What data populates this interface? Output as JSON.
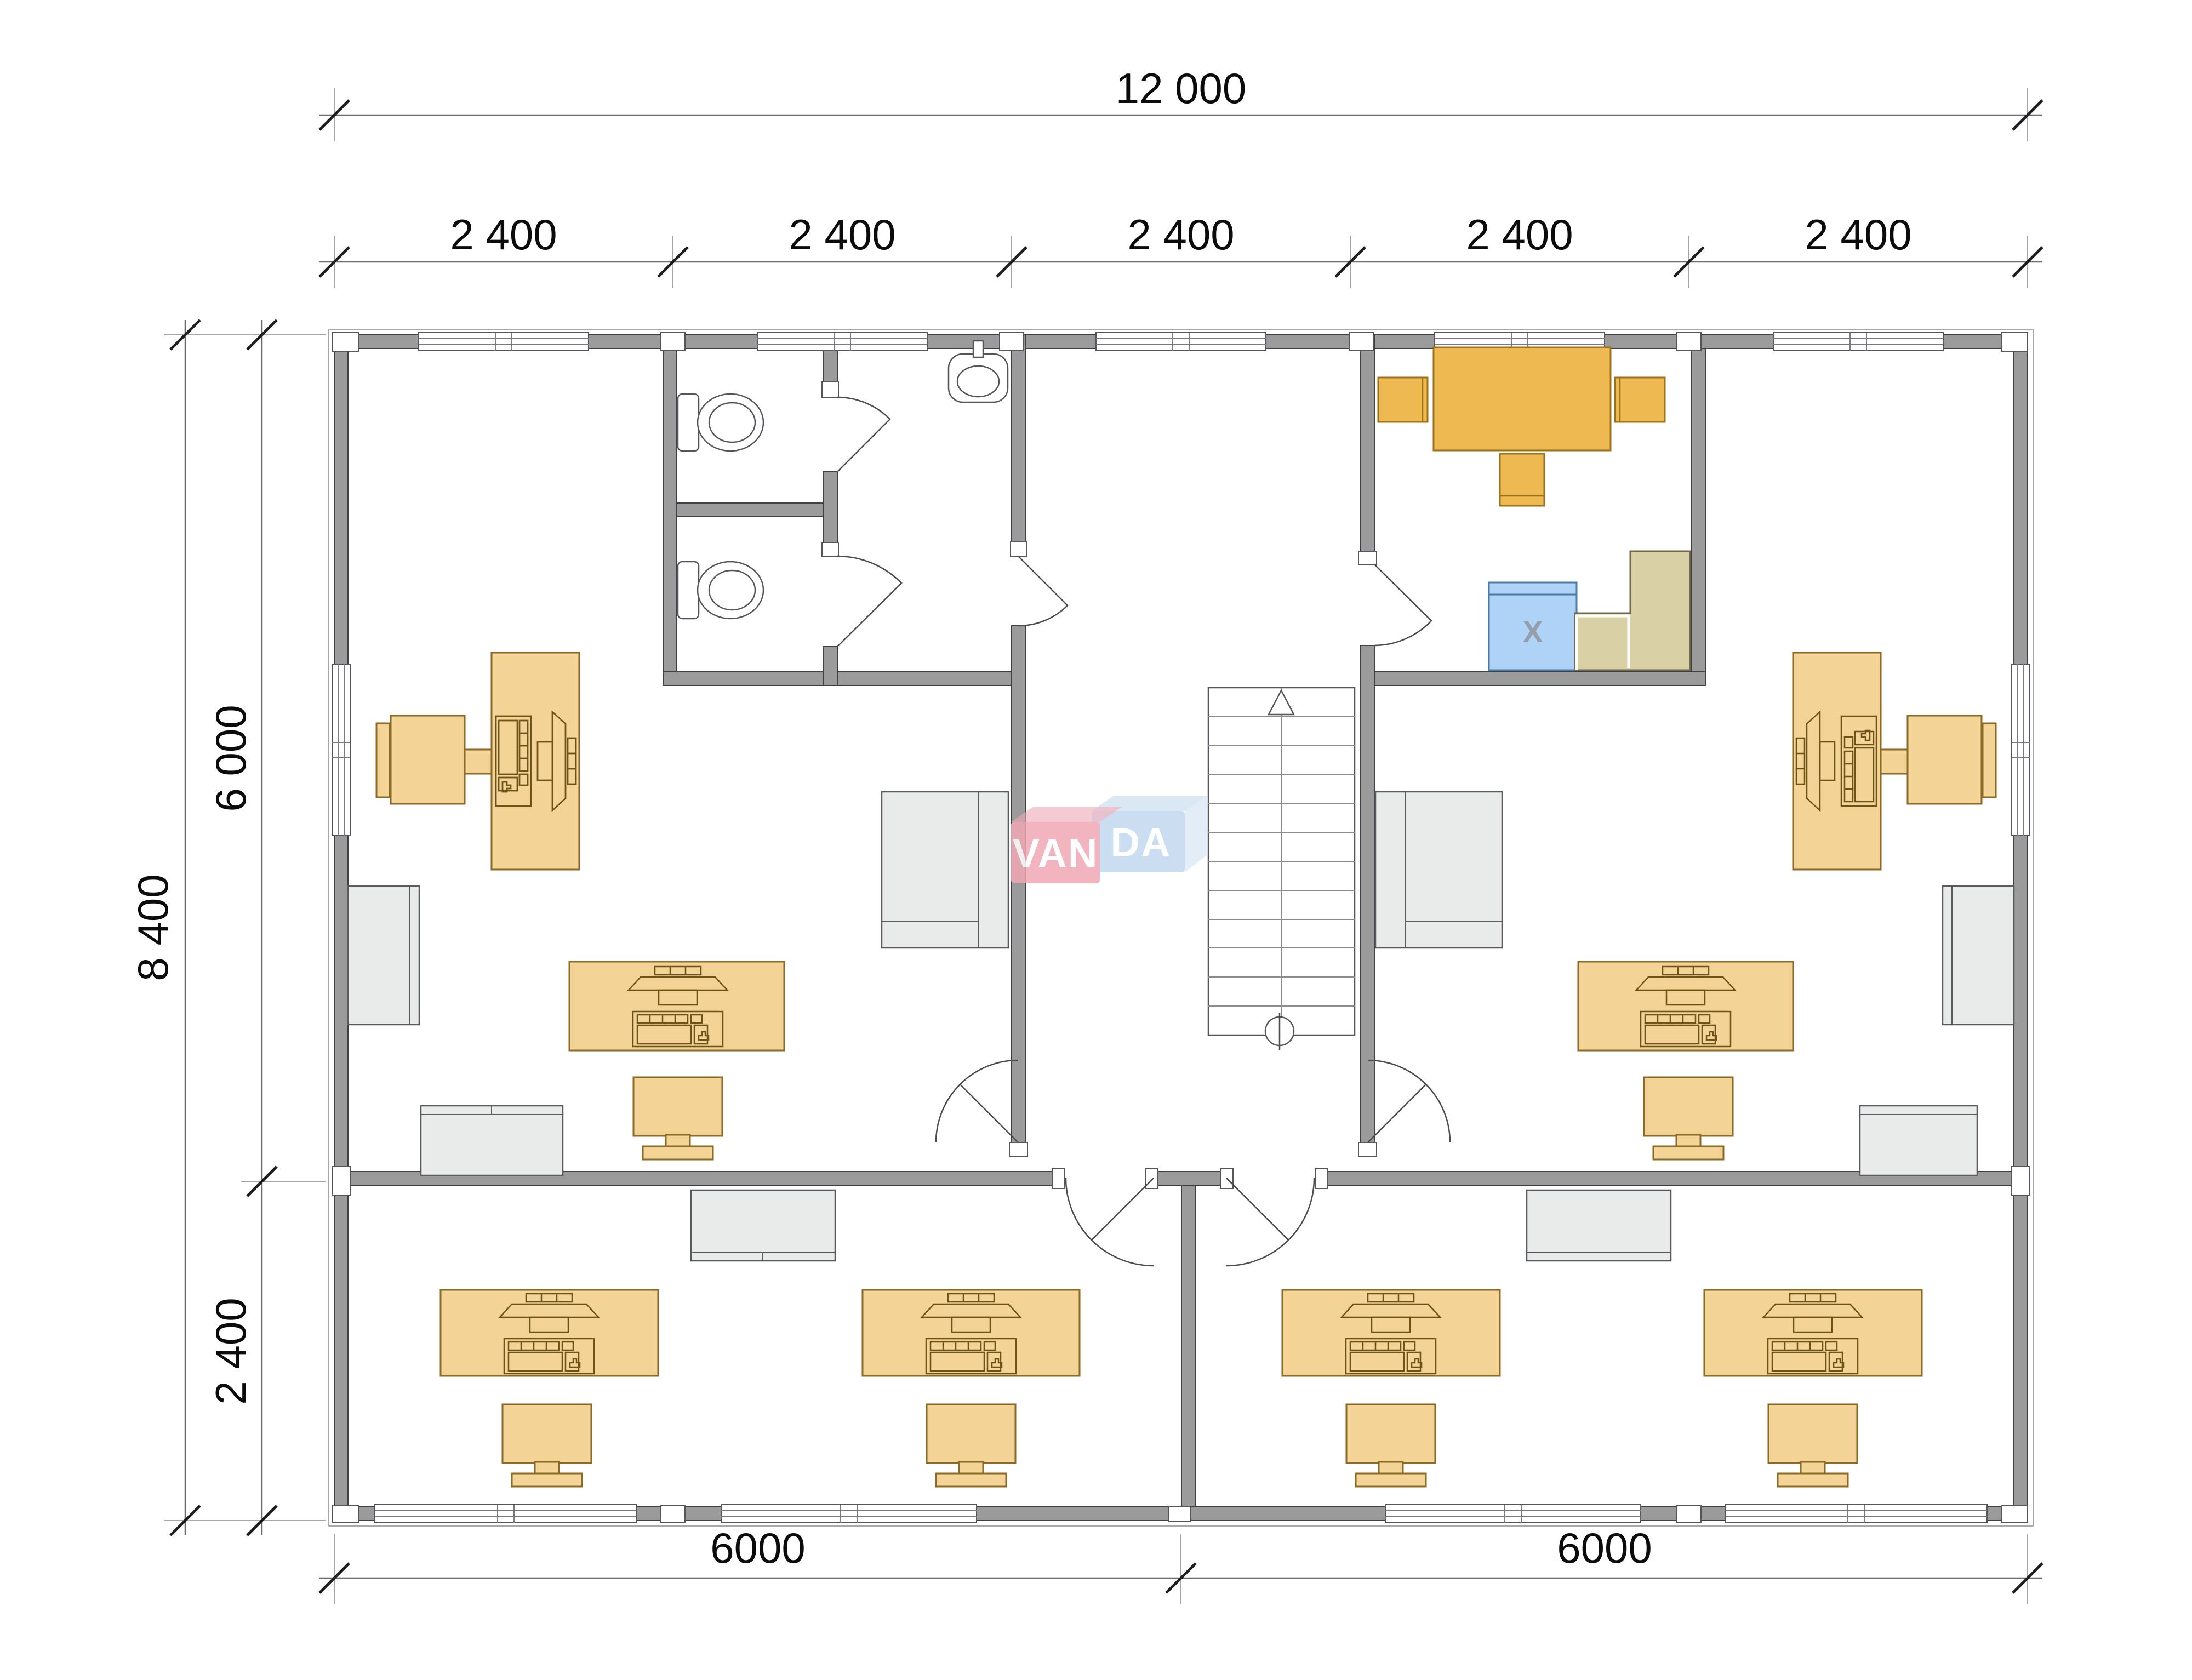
{
  "plan": {
    "title": "office-floor-plan",
    "logo": {
      "part1": "VAN",
      "part2": "DA",
      "full": "VANDA"
    },
    "dimensions": {
      "top_total": "12 000",
      "bays": [
        "2 400",
        "2 400",
        "2 400",
        "2 400",
        "2 400"
      ],
      "left_total": "8 400",
      "left_upper": "6 000",
      "left_lower": "2 400",
      "bottom_left": "6000",
      "bottom_right": "6000"
    },
    "labels": {
      "appliance_x": "X"
    },
    "colors": {
      "wall": "#9b9b9b",
      "furniture": "#f3d396",
      "accent_table": "#eeb950",
      "appliance_blue": "#aed3f6",
      "counter": "#d9d0a5",
      "light_gray": "#e9eaea",
      "logo_pink": "#f0a9b6",
      "logo_blue": "#c2d8ee"
    }
  }
}
